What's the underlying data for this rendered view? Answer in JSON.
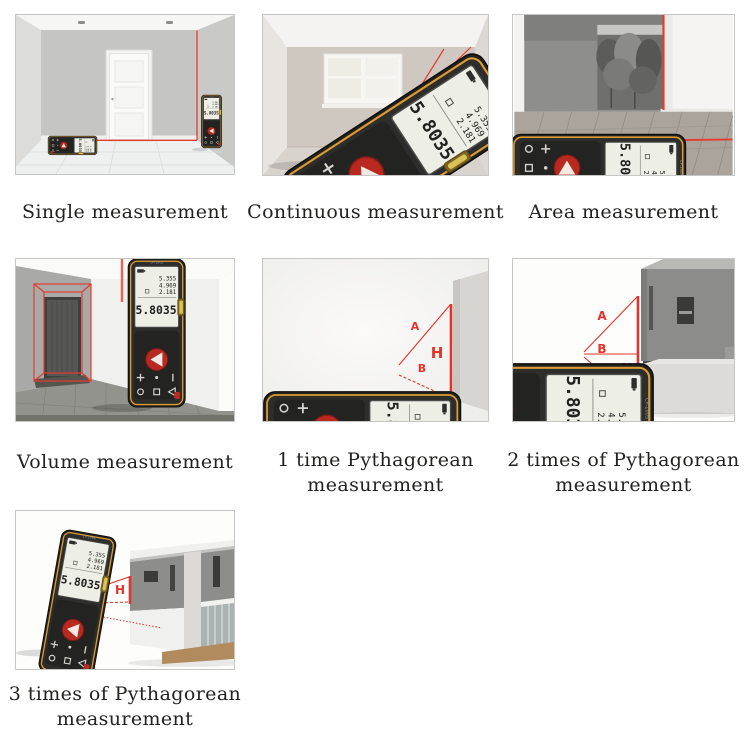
{
  "captions": {
    "single": "Single measurement",
    "continuous": "Continuous measurement",
    "area": "Area measurement",
    "volume": "Volume measurement",
    "pyth1": "1 time Pythagorean measurement",
    "pyth2": "2 times of Pythagorean measurement",
    "pyth3": "3 times of Pythagorean measurement"
  },
  "device": {
    "model": "CP-100S",
    "display": {
      "line1": "5.355",
      "line2": "4.969",
      "line3": "2.181",
      "main": "5.8035"
    }
  },
  "measure_labels": {
    "a": "A",
    "b": "B",
    "c": "C",
    "h": "H"
  },
  "colors": {
    "laser_red": "#e2342a",
    "device_body": "#222220",
    "device_trim": "#dd9b33",
    "screen": "#edeee6"
  }
}
